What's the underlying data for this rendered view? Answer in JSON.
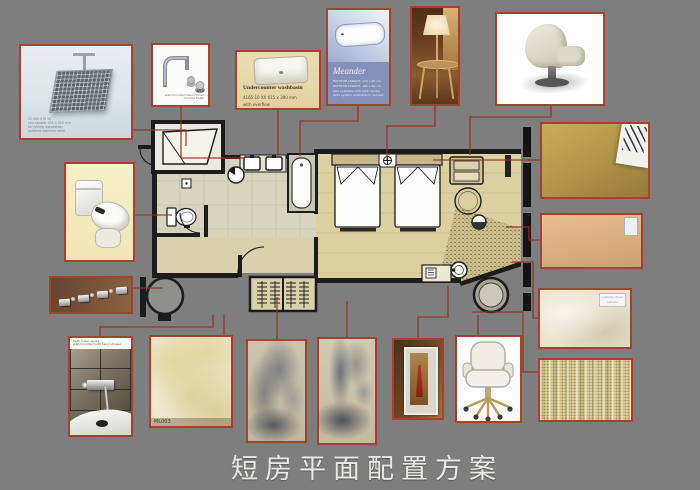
{
  "board": {
    "title": "短房平面配置方案"
  },
  "cards": {
    "shower_head": {
      "caption_lines": [
        "31 980 970 90",
        "rain shower 450 x 450 mm",
        "for ceiling installation",
        "polished stainless steel"
      ]
    },
    "basin_mixer": {
      "code": "693",
      "caption_lines": [
        "wall-mounted basin mixer",
        "chrome finish"
      ]
    },
    "washbasin": {
      "title": "Undercounter washbasin",
      "spec": "4165 10 XX   615 x 390 mm",
      "note": "with overflow"
    },
    "bathtub": {
      "title": "Meander",
      "spec_lines": [
        "BATHTUB LENGTH: 170 x 80 cm",
        "BATHTUB LENGTH: 180 x 80 cm",
        "also available with bath handle",
        "whirl system available on request"
      ]
    },
    "bath_mixer": {
      "brand_lines": [
        "bath mixer series",
        "wall-mounted with hand shower"
      ]
    },
    "marble_tile": {
      "label": "ML003"
    },
    "stone_sample": {
      "label_lines": [
        "natural stone",
        "sample"
      ]
    }
  },
  "colors": {
    "background": "#7e7e7e",
    "card_border": "#a5412e",
    "connector_line": "#94301f",
    "plan_wall": "#1c1c1c",
    "bedroom_floor": "#dccfa0",
    "bath_floor": "#d8d4be"
  }
}
